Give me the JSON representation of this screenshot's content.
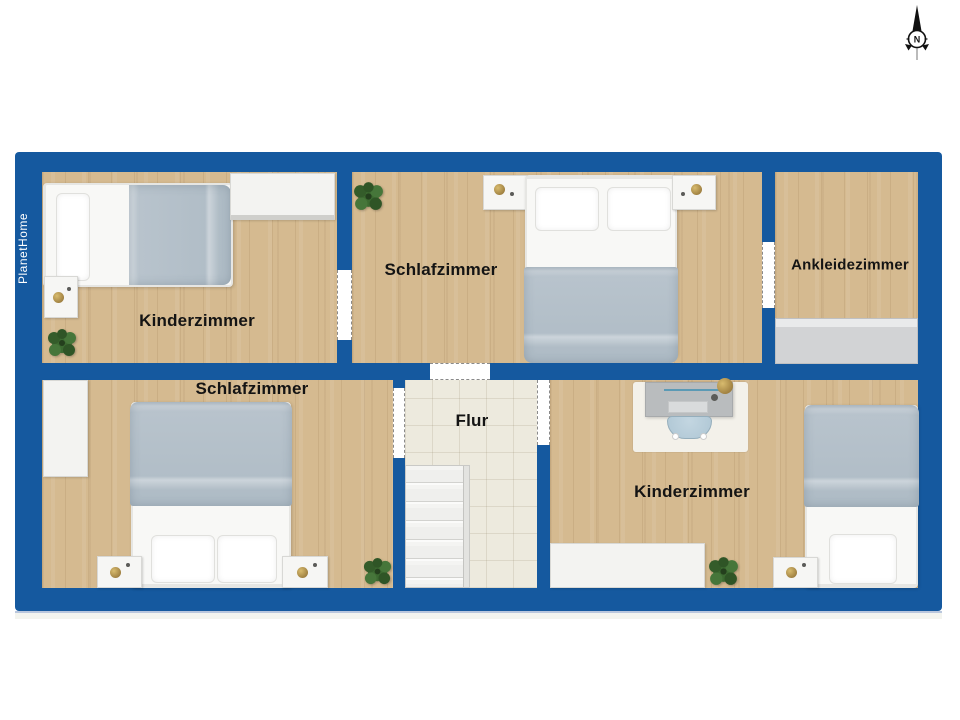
{
  "brand": {
    "name": "PlanetHome"
  },
  "compass": {
    "north_label": "N"
  },
  "rooms": [
    {
      "id": "kinderzimmer-top-left",
      "label": "Kinderzimmer"
    },
    {
      "id": "schlafzimmer-top",
      "label": "Schlafzimmer"
    },
    {
      "id": "ankleidezimmer",
      "label": "Ankleidezimmer"
    },
    {
      "id": "schlafzimmer-bottom-left",
      "label": "Schlafzimmer"
    },
    {
      "id": "flur",
      "label": "Flur"
    },
    {
      "id": "kinderzimmer-bottom-right",
      "label": "Kinderzimmer"
    }
  ],
  "colors": {
    "wall_blue": "#15599f",
    "wood_floor": "#d5ba90",
    "tile_floor": "#edeade",
    "blanket": "#b9c4cd",
    "wardrobe_gray": "#d2d3d5",
    "desk_gray": "#b9bcbe",
    "chair_blue": "#aec6d4",
    "plant_green": "#3c6a31",
    "label_text": "#141414",
    "brand_text": "#ffffff"
  }
}
